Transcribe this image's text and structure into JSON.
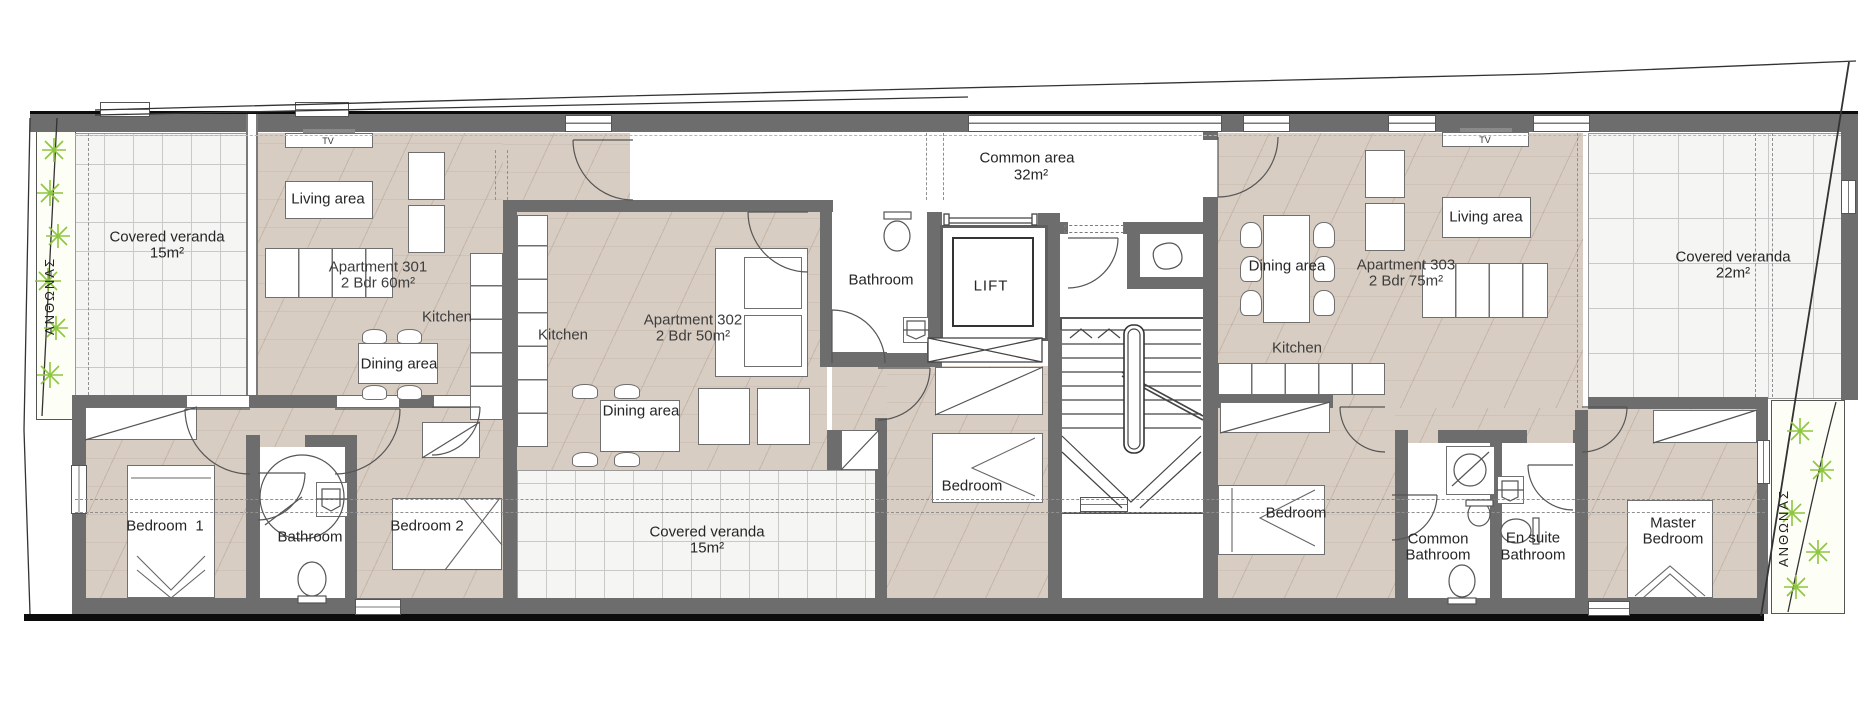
{
  "plan_type": "floor-plan",
  "colors": {
    "wall": "#6d6d6d",
    "apartment_floor": "#d8cdc3",
    "veranda_floor": "#f5f5f4",
    "garden_green": "#8dc63f",
    "outline_black": "#0c0c0c"
  },
  "labels": {
    "veranda_left": {
      "name": "Covered veranda",
      "area": "15m²"
    },
    "veranda_bottom": {
      "name": "Covered veranda",
      "area": "15m²"
    },
    "veranda_right": {
      "name": "Covered veranda",
      "area": "22m²"
    },
    "common_area": {
      "name": "Common area",
      "area": "32m²"
    },
    "lift": "LIFT",
    "tv": "TV",
    "garden": "ΑΝΘΩΝΑΣ",
    "apt301": {
      "name": "Apartment 301",
      "size": "2 Bdr 60m²",
      "living": "Living area",
      "kitchen": "Kitchen",
      "dining": "Dining area",
      "bedroom1": "Bedroom  1",
      "bathroom": "Bathroom",
      "bedroom2": "Bedroom 2"
    },
    "apt302": {
      "name": "Apartment 302",
      "size": "2 Bdr 50m²",
      "kitchen": "Kitchen",
      "dining": "Dining area",
      "bathroom": "Bathroom",
      "bedroom": "Bedroom"
    },
    "apt303": {
      "name": "Apartment 303",
      "size": "2 Bdr 75m²",
      "dining": "Dining area",
      "living": "Living area",
      "kitchen": "Kitchen",
      "bedroom": "Bedroom",
      "common_bath_line1": "Common",
      "common_bath_line2": "Bathroom",
      "ensuite_line1": "En suite",
      "ensuite_line2": "Bathroom",
      "master_line1": "Master",
      "master_line2": "Bedroom"
    }
  }
}
